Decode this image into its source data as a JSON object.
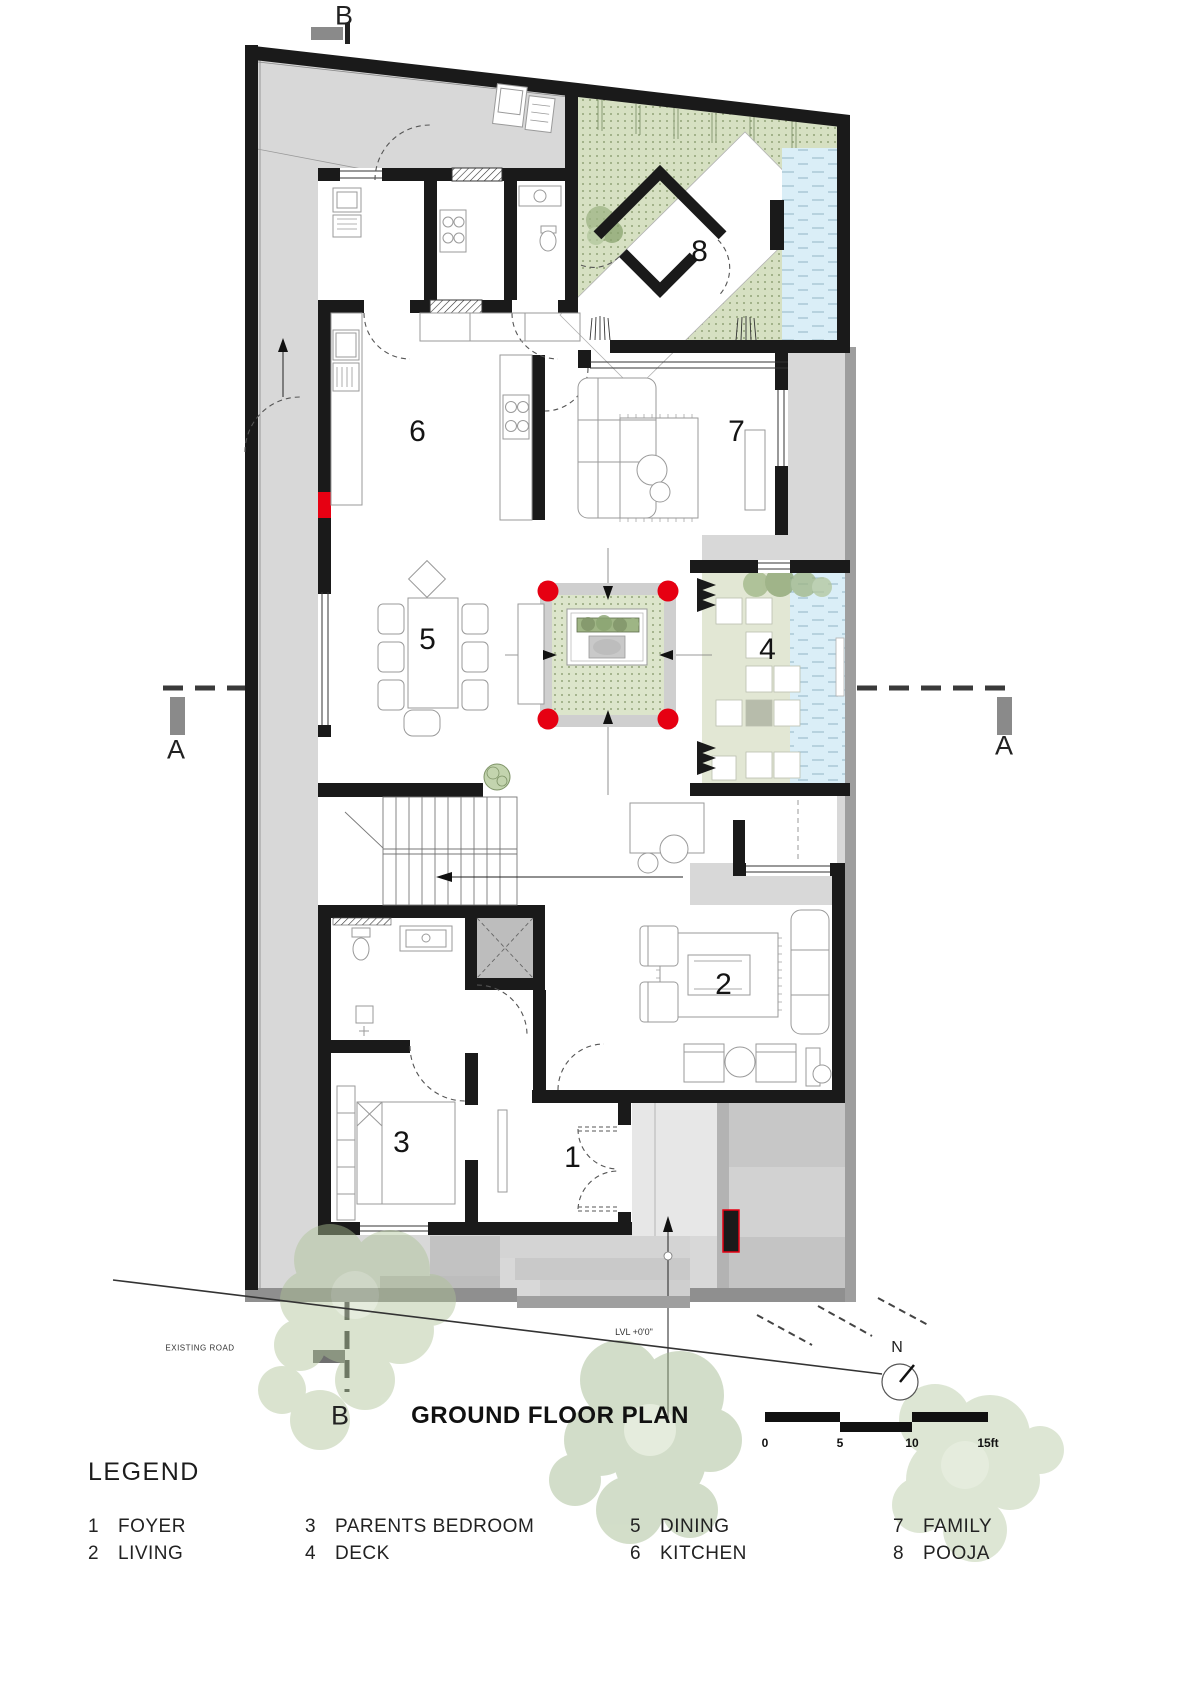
{
  "title": "GROUND FLOOR PLAN",
  "legend_heading": "LEGEND",
  "rooms": [
    {
      "num": "1",
      "label": "FOYER"
    },
    {
      "num": "2",
      "label": "LIVING"
    },
    {
      "num": "3",
      "label": "PARENTS BEDROOM"
    },
    {
      "num": "4",
      "label": "DECK"
    },
    {
      "num": "5",
      "label": "DINING"
    },
    {
      "num": "6",
      "label": "KITCHEN"
    },
    {
      "num": "7",
      "label": "FAMILY"
    },
    {
      "num": "8",
      "label": "POOJA"
    }
  ],
  "section_markers": {
    "a": "A",
    "b": "B"
  },
  "north_label": "N",
  "scale_bar": {
    "ticks": [
      "0",
      "5",
      "10",
      "15ft"
    ]
  },
  "annotations": {
    "existing_road": "EXISTING ROAD",
    "level": "LVL +0'0\""
  },
  "colors": {
    "wall": "#1a1a1a",
    "site_gray": "#d8d8d8",
    "garden_green": "#d6e0c2",
    "pool_blue": "#daeef7",
    "accent_red": "#e60012",
    "tree_green": "#b5c9a0"
  }
}
